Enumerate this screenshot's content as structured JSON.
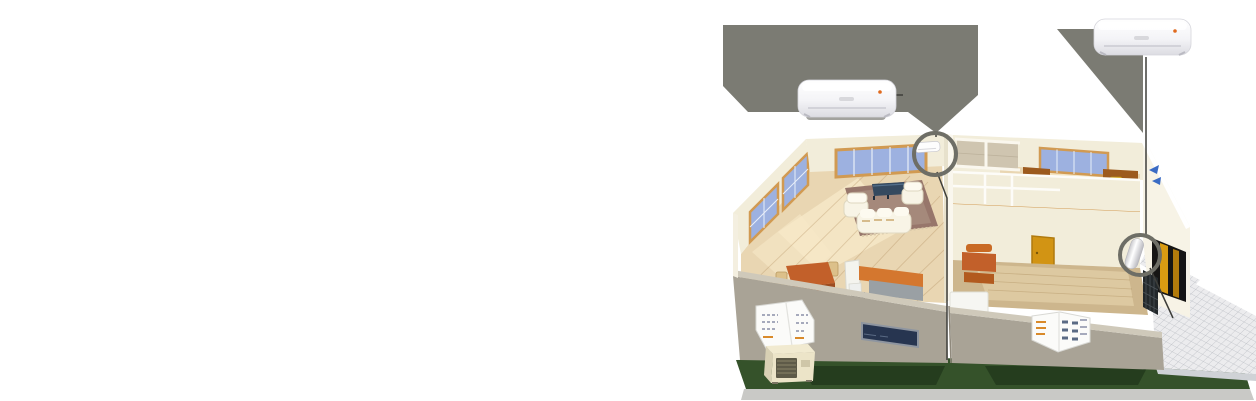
{
  "scene": {
    "kind": "isometric-cutaway-home-with-split-air-conditioning",
    "rooms": [
      "living-room",
      "kitchen-dining",
      "study-room",
      "bedroom-room",
      "hallway",
      "entrance"
    ],
    "products": {
      "enlarged_indoor_units": 2,
      "installed_indoor_units": 2,
      "outdoor_condenser_units": 1
    },
    "callouts": [
      {
        "name": "living-room-indoor-unit-callout",
        "marker": "circle",
        "connector": "beam-and-line"
      },
      {
        "name": "entrance-indoor-unit-callout",
        "marker": "circle",
        "connector": "beam-and-line"
      }
    ]
  },
  "palette": {
    "pageBg": "#ffffff",
    "calloutGray": "#7b7b73",
    "calloutShadow": "#55554e",
    "ringGray": "#6e6e66",
    "lineDark": "#3e3e3a",
    "acWhite": "#f7f7f9",
    "acEdge": "#d5d5db",
    "accentOrange": "#e06a1e",
    "wallCream": "#f2edda",
    "wallCreamShade": "#e7e1cc",
    "wallWhite": "#faf7ee",
    "wallFrontGray": "#a9a396",
    "wallTopEdge": "#cfc9ba",
    "floorTan": "#e9d6b2",
    "floorLight": "#f6e8c8",
    "floorWood": "#cdb68d",
    "matLight": "#ddc9a1",
    "hallFloorGray": "#cfc5b0",
    "rugMauve": "#97766b",
    "rugInner": "#a5897b",
    "sofaCream": "#f8f4e6",
    "tableNavy": "#35495f",
    "woodOrange": "#c2602a",
    "chairTan": "#dcc08a",
    "counterOrange": "#d4772f",
    "counterGray": "#9aa0a4",
    "deskBrown": "#9c5a1e",
    "chairYellow": "#e4b21f",
    "glassBlue": "#9db1e0",
    "frameTan": "#d19a52",
    "doorAmber": "#d29414",
    "matBrown": "#6e3f17",
    "entranceBlack": "#161514",
    "lawnGreen": "#35522a",
    "lawnShadow": "#22391c",
    "baseGray": "#c9c9c6",
    "tileWhite": "#ececee",
    "tileLine": "#b9bcc2",
    "logoBlue": "#3a6bc4",
    "outdoorCream": "#ece4c8",
    "navyWindow": "#273550",
    "paperWhite": "#fbfbf9"
  }
}
